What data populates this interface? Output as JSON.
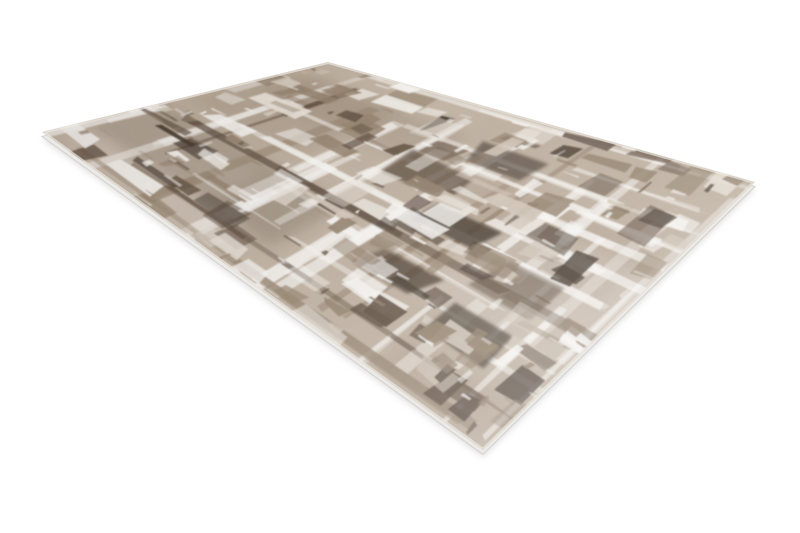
{
  "canvas": {
    "width": 800,
    "height": 533,
    "background": "#ffffff"
  },
  "product_photo": {
    "subject": "abstract distressed beige-brown area rug, angled product photo on white background",
    "corners": {
      "top": [
        328,
        62
      ],
      "right": [
        755,
        182
      ],
      "bottom": [
        483,
        450
      ],
      "left": [
        42,
        132
      ]
    },
    "edge_thickness_px": 4.5,
    "shadow_offset_px": 7,
    "palette": {
      "base": "#bfb1a1",
      "base_light": "#d3c8ba",
      "white": "#f8f6f3",
      "light": "#e8e1d8",
      "medium": "#94826e",
      "dark": "#5d4c3e",
      "darkest": "#463a2f",
      "side": "#eceae7",
      "side_shade": "#d6d3cf",
      "edge_highlight": "#f0ece6",
      "shadow": "#c3c3c3"
    },
    "pattern": {
      "seed": 20,
      "washes": 9,
      "channels_v": 16,
      "channels_u": 13,
      "dark_blobs": 6,
      "patches": 165,
      "streaks": 120,
      "jitter": 0.014,
      "color_weights": {
        "white": 0.24,
        "light": 0.12,
        "base_light": 0.08,
        "medium": 0.22,
        "dark": 0.24,
        "darkest": 0.1
      }
    }
  }
}
